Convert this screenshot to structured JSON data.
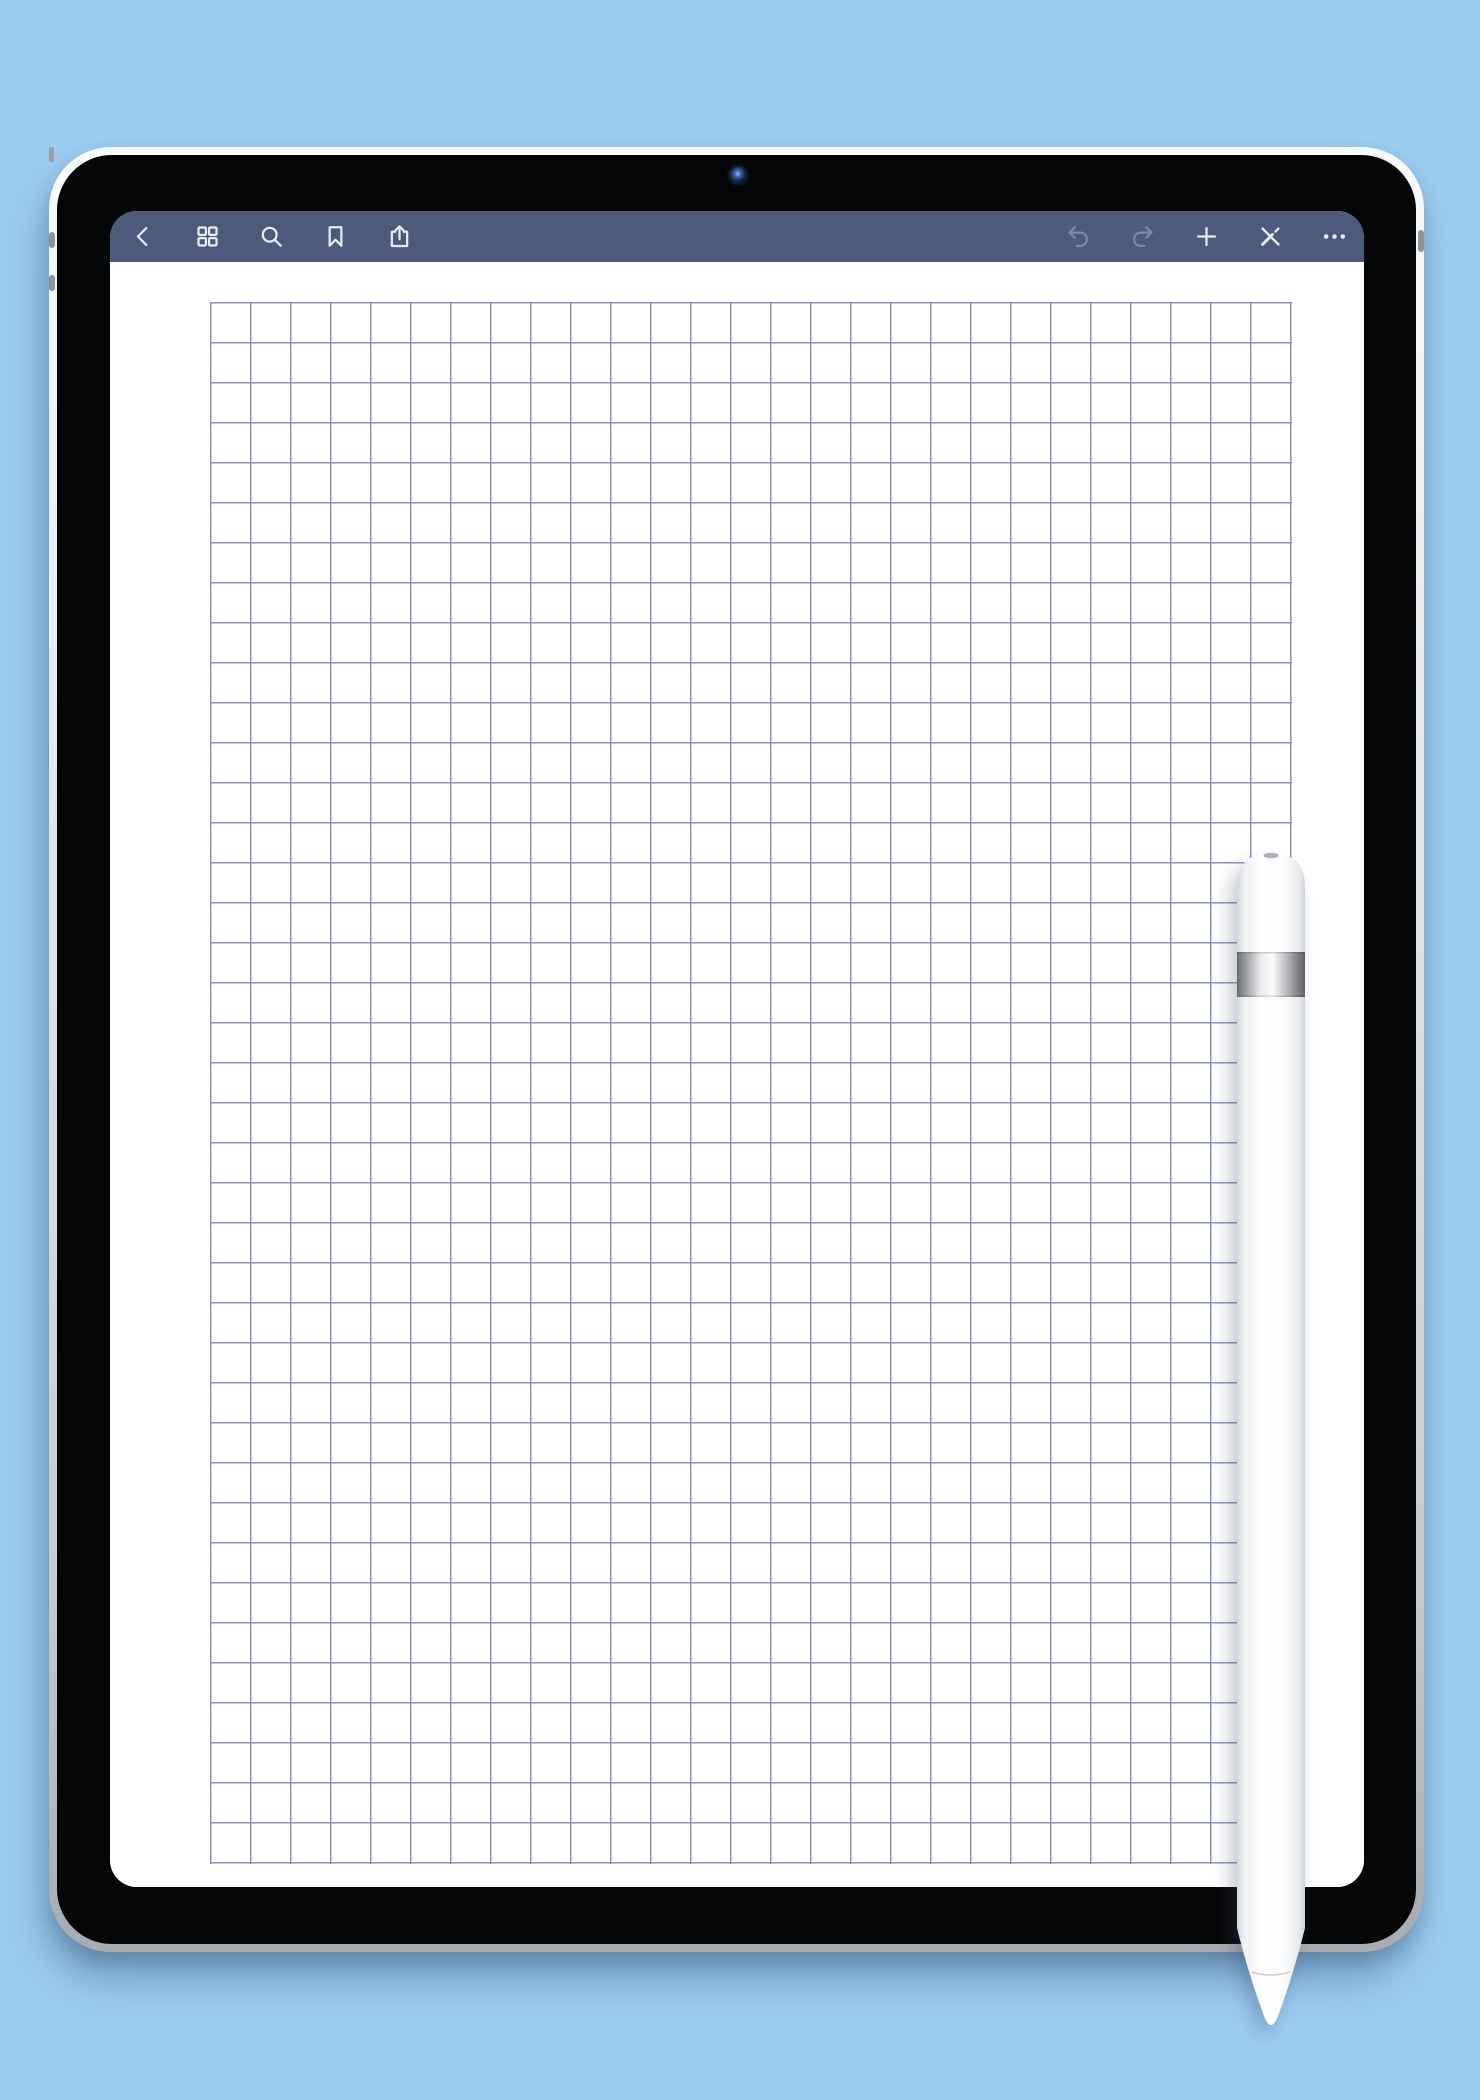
{
  "scene": {
    "background_color": "#9bccf1",
    "description": "Tablet note-taking app mockup showing a blank square-grid graph paper page with a stylus resting over the right side"
  },
  "device": {
    "type": "tablet",
    "frame_color": "#e7eaee",
    "bezel_color": "#050607",
    "camera": {
      "name": "front-camera"
    },
    "side_buttons": [
      "volume-up",
      "volume-down",
      "top-button"
    ]
  },
  "toolbar": {
    "background_color": "#4c5a7b",
    "icon_color": "#e9edf4",
    "disabled_icon_color": "#7e89a7",
    "left_icons": [
      {
        "name": "back-chevron-icon",
        "enabled": true
      },
      {
        "name": "thumbnails-grid-icon",
        "enabled": true
      },
      {
        "name": "search-icon",
        "enabled": true
      },
      {
        "name": "bookmark-icon",
        "enabled": true
      },
      {
        "name": "share-icon",
        "enabled": true
      }
    ],
    "right_icons": [
      {
        "name": "undo-icon",
        "enabled": false
      },
      {
        "name": "redo-icon",
        "enabled": false
      },
      {
        "name": "add-page-icon",
        "enabled": true
      },
      {
        "name": "pencil-x-icon",
        "enabled": true
      },
      {
        "name": "more-options-icon",
        "enabled": true
      }
    ]
  },
  "page": {
    "background_color": "#ffffff",
    "content": "blank graph paper",
    "grid": {
      "columns": 27,
      "rows": 39,
      "cell_size_px": 40,
      "line_width_px": 1.6,
      "line_color": "#8b91c4"
    }
  },
  "stylus": {
    "name": "apple-pencil-style-stylus",
    "body_color": "#ffffff",
    "band_color": "#c7c9cd"
  }
}
